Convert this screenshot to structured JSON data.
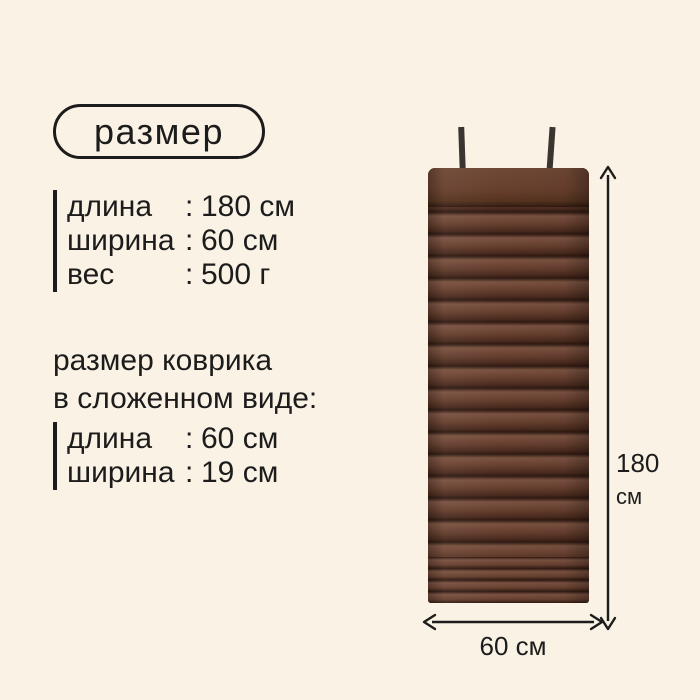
{
  "theme": {
    "background": "#faf2e4",
    "ink": "#1c1c1c",
    "mat_light": "#7b5241",
    "mat_mid": "#663f2f",
    "mat_dark": "#4a2a1d",
    "mat_seam": "#2f1a12",
    "strap": "#3a3531"
  },
  "separator": ":",
  "badge": {
    "label": "размер"
  },
  "specs_main": {
    "rows": [
      {
        "label": "длина",
        "value": "180 см"
      },
      {
        "label": "ширина",
        "value": "60 см"
      },
      {
        "label": "вес",
        "value": "500 г"
      }
    ]
  },
  "folded_specs": {
    "heading_line1": "размер коврика",
    "heading_line2": "в сложенном виде:",
    "rows": [
      {
        "label": "длина",
        "value": "60 см"
      },
      {
        "label": "ширина",
        "value": "19 см"
      }
    ]
  },
  "dimension_labels": {
    "height_value": "180",
    "height_unit": "см",
    "width": "60 см"
  }
}
